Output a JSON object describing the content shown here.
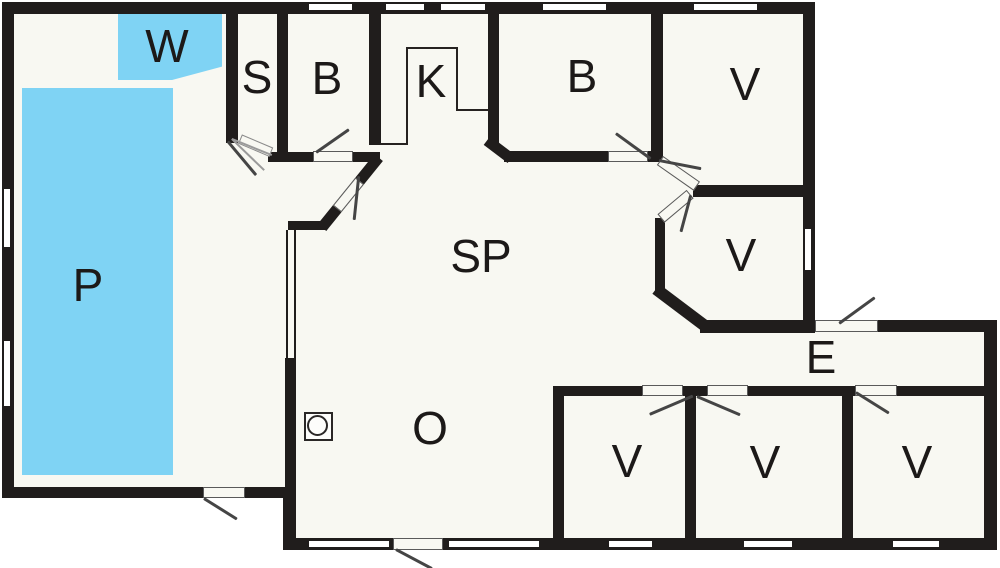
{
  "title": "Holiday home floor plan",
  "rooms": [
    {
      "name": "room-w",
      "label": "W"
    },
    {
      "name": "room-p",
      "label": "P"
    },
    {
      "name": "room-s",
      "label": "S"
    },
    {
      "name": "room-b1",
      "label": "B"
    },
    {
      "name": "room-k",
      "label": "K"
    },
    {
      "name": "room-b2",
      "label": "B"
    },
    {
      "name": "room-v1",
      "label": "V"
    },
    {
      "name": "room-v2",
      "label": "V"
    },
    {
      "name": "room-sp",
      "label": "SP"
    },
    {
      "name": "room-e",
      "label": "E"
    },
    {
      "name": "room-o",
      "label": "O"
    },
    {
      "name": "room-v3",
      "label": "V"
    },
    {
      "name": "room-v4",
      "label": "V"
    },
    {
      "name": "room-v5",
      "label": "V"
    }
  ],
  "colors": {
    "wall": "#201D1C",
    "floor": "#F8F8F2",
    "pool": "#7FD3F4",
    "swing": "#454545"
  }
}
